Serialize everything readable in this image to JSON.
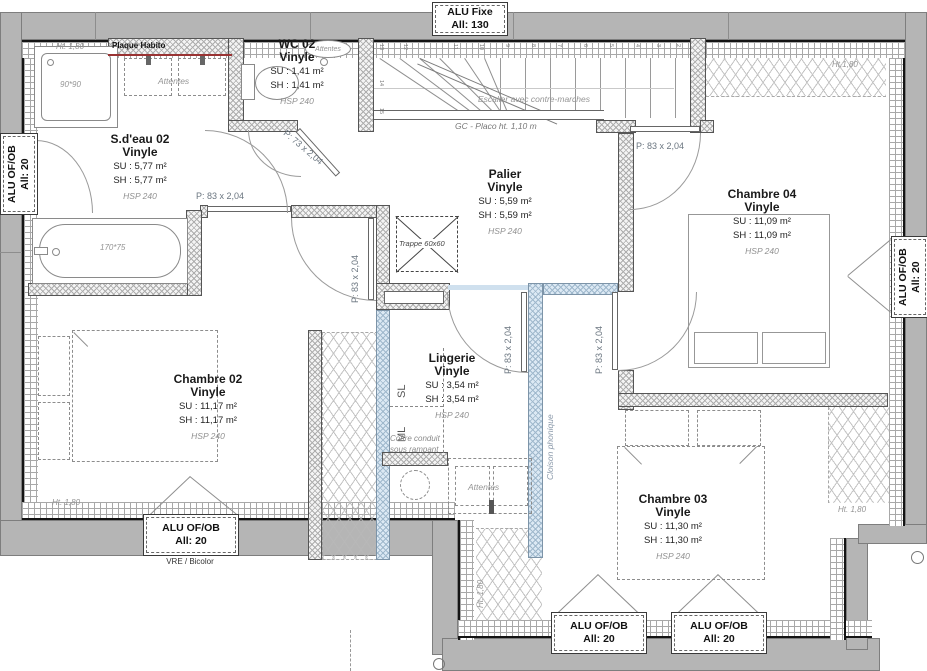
{
  "rooms": {
    "sdeau": {
      "name": "S.d'eau 02",
      "floor": "Vinyle",
      "su": "SU : 5,77 m²",
      "sh": "SH : 5,77 m²",
      "hsp": "HSP 240"
    },
    "wc": {
      "name": "WC 02",
      "floor": "Vinyle",
      "su": "SU : 1,41 m²",
      "sh": "SH : 1,41 m²",
      "hsp": "HSP 240"
    },
    "palier": {
      "name": "Palier",
      "floor": "Vinyle",
      "su": "SU : 5,59 m²",
      "sh": "SH : 5,59 m²",
      "hsp": "HSP 240"
    },
    "chambre04": {
      "name": "Chambre 04",
      "floor": "Vinyle",
      "su": "SU : 11,09 m²",
      "sh": "SH : 11,09 m²",
      "hsp": "HSP 240"
    },
    "chambre02": {
      "name": "Chambre 02",
      "floor": "Vinyle",
      "su": "SU : 11,17 m²",
      "sh": "SH : 11,17 m²",
      "hsp": "HSP 240"
    },
    "lingerie": {
      "name": "Lingerie",
      "floor": "Vinyle",
      "su": "SU : 3,54 m²",
      "sh": "SH : 3,54 m²",
      "hsp": "HSP 240"
    },
    "chambre03": {
      "name": "Chambre 03",
      "floor": "Vinyle",
      "su": "SU : 11,30 m²",
      "sh": "SH : 11,30 m²",
      "hsp": "HSP 240"
    }
  },
  "windows": {
    "top": {
      "l1": "ALU Fixe",
      "l2": "All:  130"
    },
    "left": {
      "l1": "ALU OF/OB",
      "l2": "All:  20"
    },
    "right": {
      "l1": "ALU OF/OB",
      "l2": "All:  20"
    },
    "bottom_left": {
      "l1": "ALU OF/OB",
      "l2": "All:  20",
      "note": "VRE / Bicolor"
    },
    "bottom_mid": {
      "l1": "ALU OF/OB",
      "l2": "All:  20"
    },
    "bottom_right": {
      "l1": "ALU OF/OB",
      "l2": "All:  20"
    }
  },
  "doors": {
    "sdeau": "P: 83 x 2,04",
    "chambre02": "P: 83 x 2,04",
    "wc": "P: 73 x 2,04",
    "chambre04": "P: 83 x 2,04",
    "lingerie": "P: 83 x 2,04",
    "chambre03": "P: 83 x 2,04"
  },
  "stairs": {
    "label": "Escalier avec contre-marches",
    "guard": "GC - Placo ht. 1,10 m",
    "n2": "2",
    "n3": "3",
    "n4": "4",
    "n5": "5",
    "n6": "6",
    "n7": "7",
    "n8": "8",
    "n9": "9",
    "n10": "10",
    "n11": "11",
    "n12": "12",
    "n13": "13",
    "n14": "14",
    "n15": "15"
  },
  "annotations": {
    "plaque": "Plaque Habito",
    "attentes": "Attentes",
    "trappe": "Trappe 60x60",
    "coffre1": "Coffre conduit",
    "coffre2": "sous rampant",
    "cloison": "Cloison phonique",
    "sl": "SL",
    "ml": "ML",
    "shower": "90*90",
    "tub": "170*75",
    "ht180": "Ht. 1,80",
    "ht180b": "Ht.1,80"
  },
  "colors": {
    "wall": "#b5b5b5",
    "plaque_habito_red": "#993333",
    "cloison_blue": "#dce9f4",
    "label_gray": "#6b7680"
  }
}
